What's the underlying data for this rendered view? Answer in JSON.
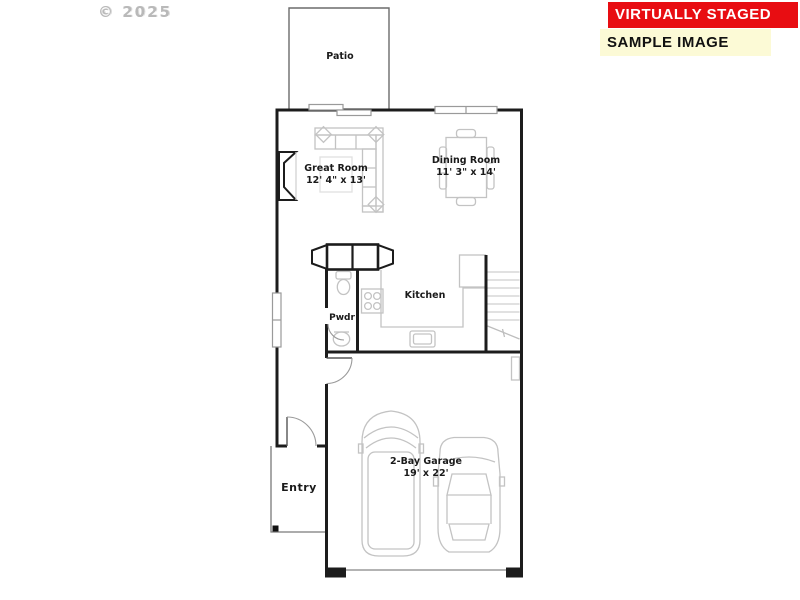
{
  "watermark": {
    "text": "© 2025"
  },
  "banners": {
    "virtually_staged": {
      "label": "VIRTUALLY STAGED",
      "bg": "#e80d12",
      "fg": "#ffffff"
    },
    "sample_image": {
      "label": "SAMPLE IMAGE",
      "bg": "#fcfad6",
      "fg": "#111111"
    }
  },
  "floorplan": {
    "rooms": {
      "patio": {
        "label": "Patio"
      },
      "great_room": {
        "label": "Great Room",
        "dimensions": "12' 4\" x 13'"
      },
      "dining_room": {
        "label": "Dining Room",
        "dimensions": "11' 3\" x 14'"
      },
      "kitchen": {
        "label": "Kitchen"
      },
      "powder": {
        "label": "Pwdr"
      },
      "entry": {
        "label": "Entry"
      },
      "garage": {
        "label": "2-Bay Garage",
        "dimensions": "19' x 22'"
      }
    },
    "colors": {
      "wall": "#1c1c1c",
      "furniture_line": "#c3c3c3",
      "door_line": "#9a9a9a",
      "label_text": "#1a1a1a"
    }
  }
}
